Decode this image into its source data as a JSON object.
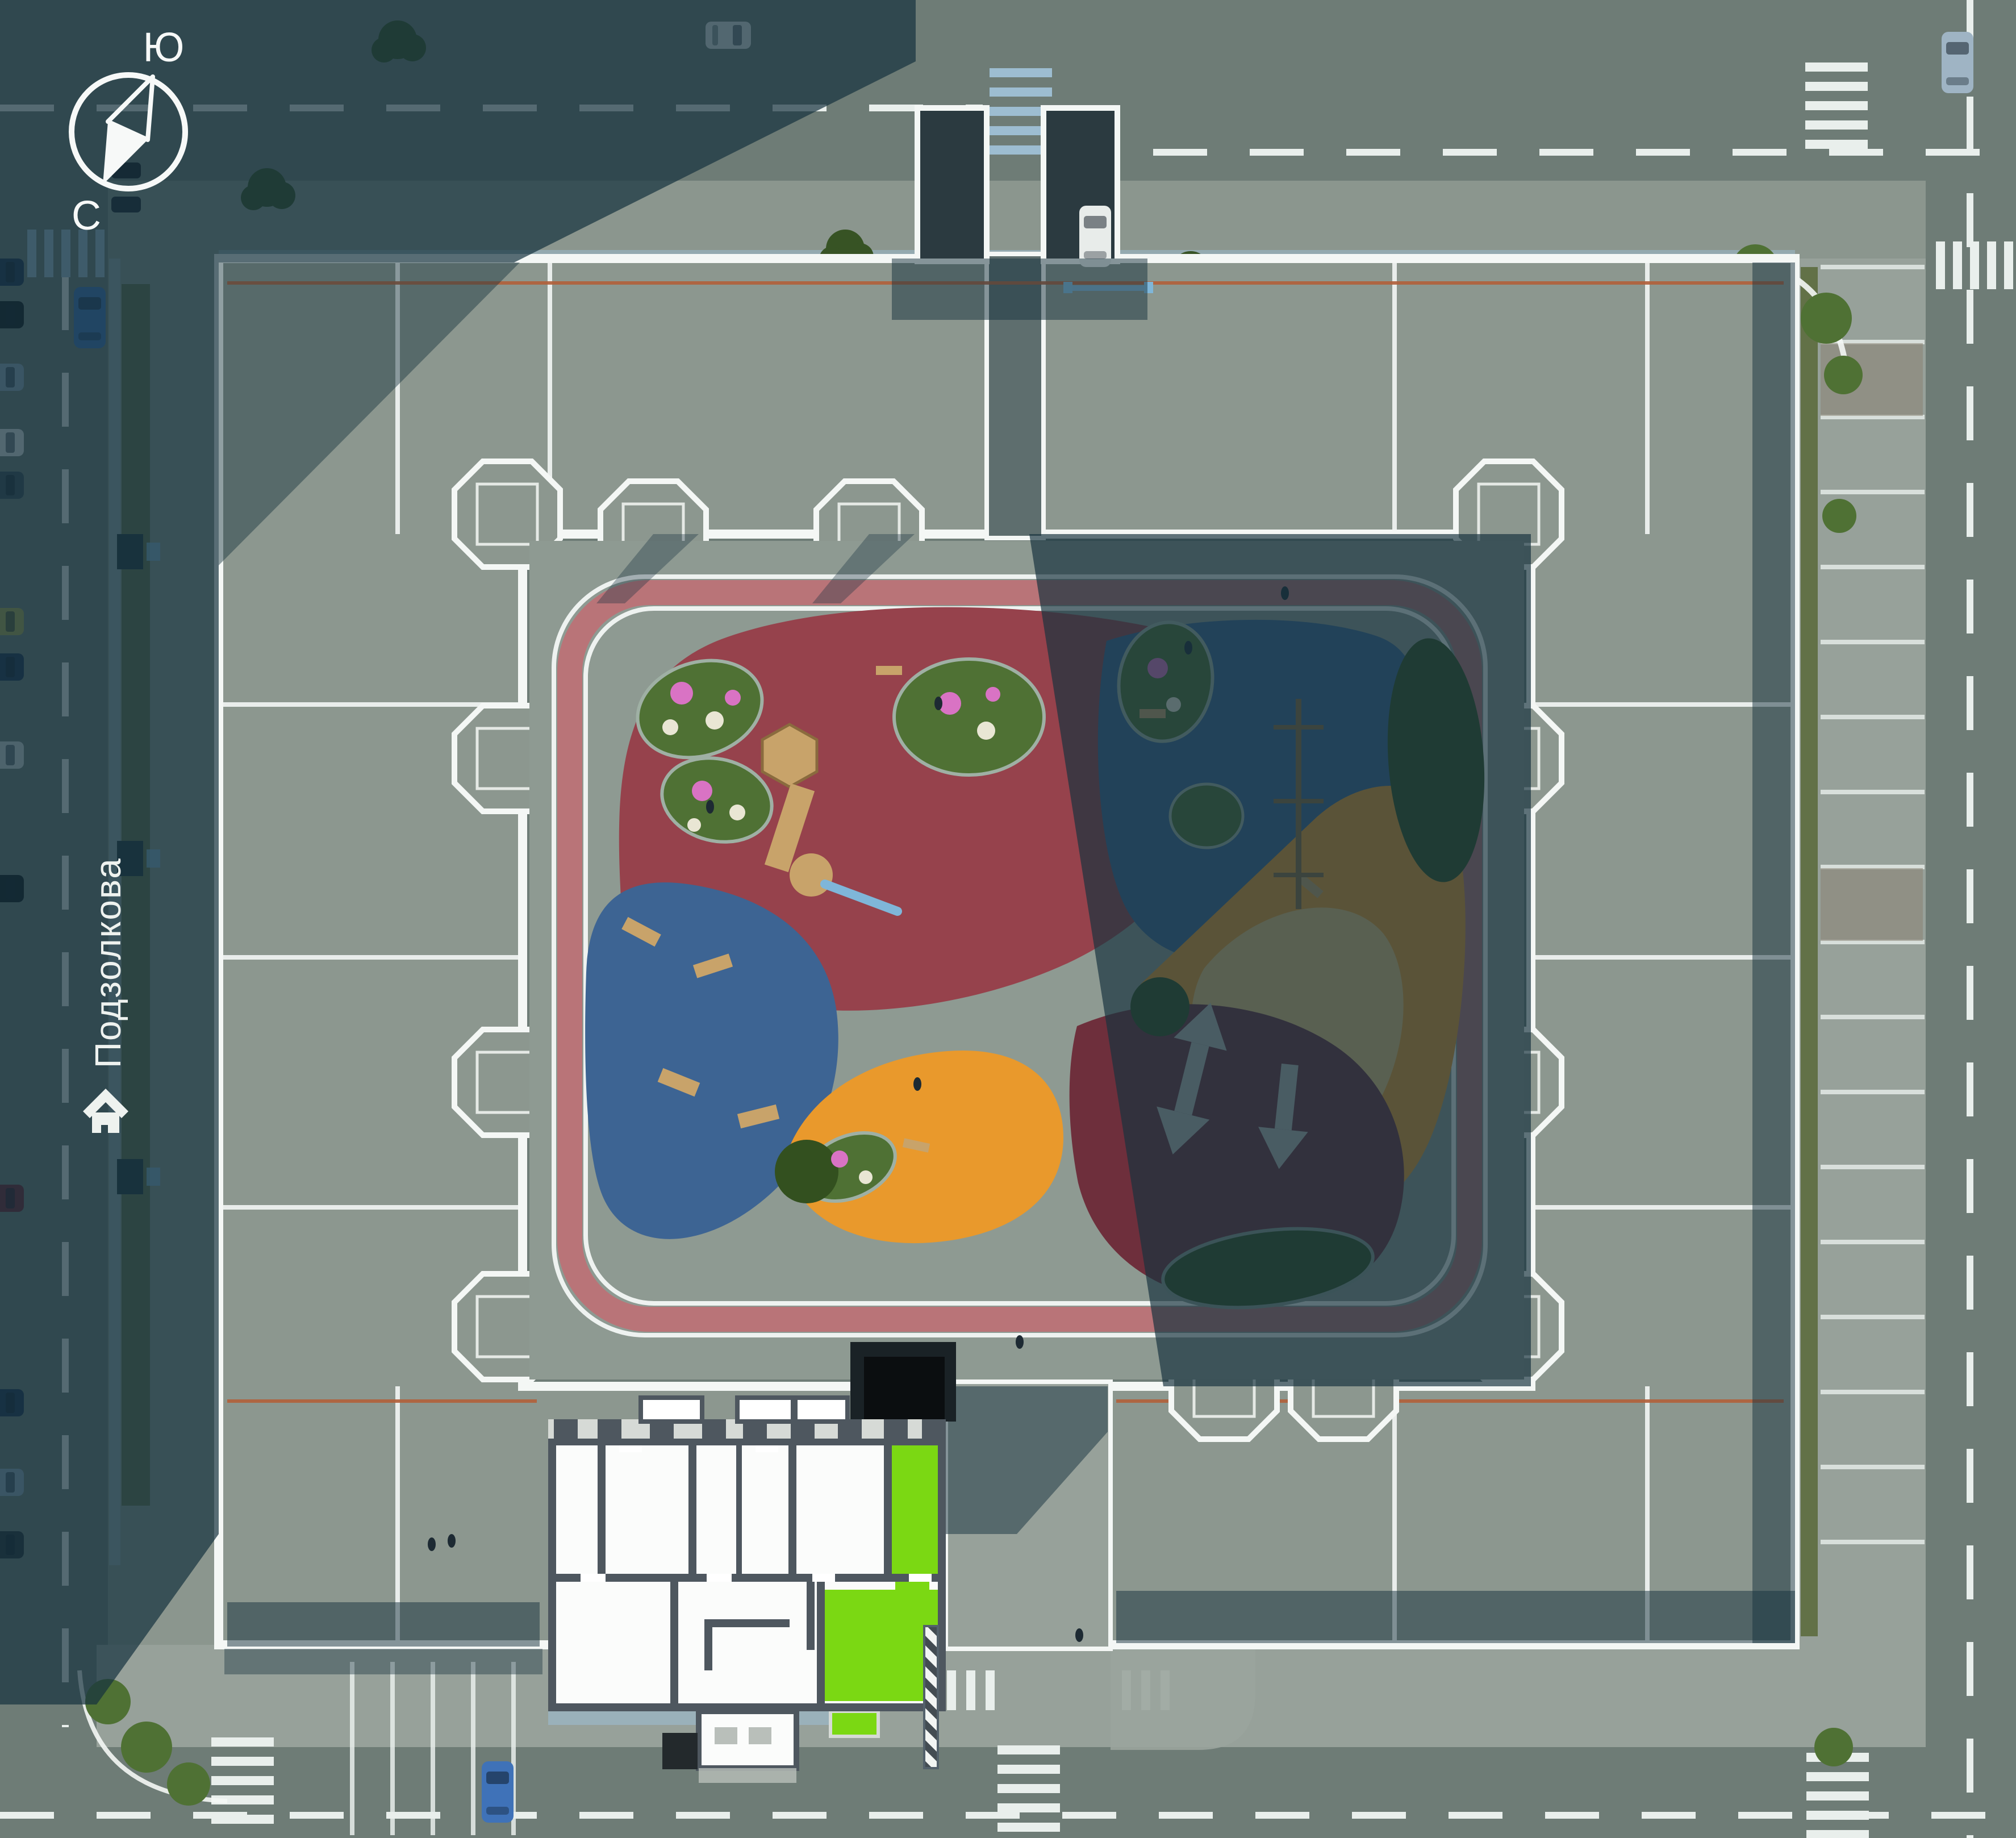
{
  "compass": {
    "south_label": "Ю",
    "north_label": "С"
  },
  "street": {
    "name": "Подзолкова"
  },
  "icons": {
    "compass": "compass-icon",
    "home": "home-icon"
  },
  "colors": {
    "asphalt": "#6e7c76",
    "plaza_lit": "#97a19a",
    "plaza_west": "#8b968e",
    "courtyard": "#8e9a92",
    "roof": "#8c978f",
    "roof_shadow_band": "#31464e",
    "tower_roof_dark": "#2b3a40",
    "black_roof": "#0b0e10",
    "black_roof_surround": "#1a2226",
    "parapet_white": "#f4f7f5",
    "accent_line_orange": "#b2603a",
    "shadow": "#16323e",
    "marking_white": "#e9efec",
    "sidewalk_blue": "#9dbdd1",
    "track_lane_pink": "#b97478",
    "track_curb": "#eef2f0",
    "concrete_pad": "#9aa49d",
    "hedge_olive": "#5c6b3e",
    "green_bush": "#4f7134",
    "green_dark": "#33501f",
    "flower_pink": "#d973c4",
    "flower_white": "#e9e6d4",
    "wood": "#c8a36a",
    "wood_dark": "#8a6b3e",
    "slide_gray": "#b9c0bd",
    "slide_blue": "#7fb6d9",
    "people_dark": "#1d2a33",
    "plan_plate": "#fbfcfb",
    "plan_wall": "#4e575f",
    "plan_room": "#ffffff",
    "plan_balcony": "#d6dad6",
    "plan_mat": "#b9bfba",
    "plan_canopy": "#23292c",
    "apartment_green": "#7bd813"
  },
  "playground_zones": [
    {
      "name": "zone-red-top-left",
      "color": "#96424c"
    },
    {
      "name": "zone-blue-left",
      "color": "#3d6493"
    },
    {
      "name": "zone-blue-top-right",
      "color": "#3d6493"
    },
    {
      "name": "zone-orange-right",
      "color": "#e9992c"
    },
    {
      "name": "zone-sand-inner",
      "color": "#e6c27b"
    },
    {
      "name": "zone-orange-bottom",
      "color": "#e9992c"
    },
    {
      "name": "zone-maroon-bottom-right",
      "color": "#6e2f3c"
    }
  ],
  "cars": {
    "parked_left": [
      "#1c2f4e",
      "#10141a",
      "#8fa9bc",
      "#dfe5e4",
      "#3a4a55",
      "#a8a84e",
      "#1c2f4e",
      "#cfd8d8",
      "#10141a",
      "#6e1f2c",
      "#1c2f4e",
      "#8fa9bc",
      "#222c35"
    ],
    "parked_top_west": [
      "#141a20",
      "#1c242c"
    ],
    "moving": {
      "top_van": "#dfe5e4",
      "left_blue_car": "#3f72b8",
      "entrance_white_car": "#e8ecea",
      "right_gray_car": "#9fb4c4",
      "bottom_blue_car": "#3f72b8"
    }
  }
}
